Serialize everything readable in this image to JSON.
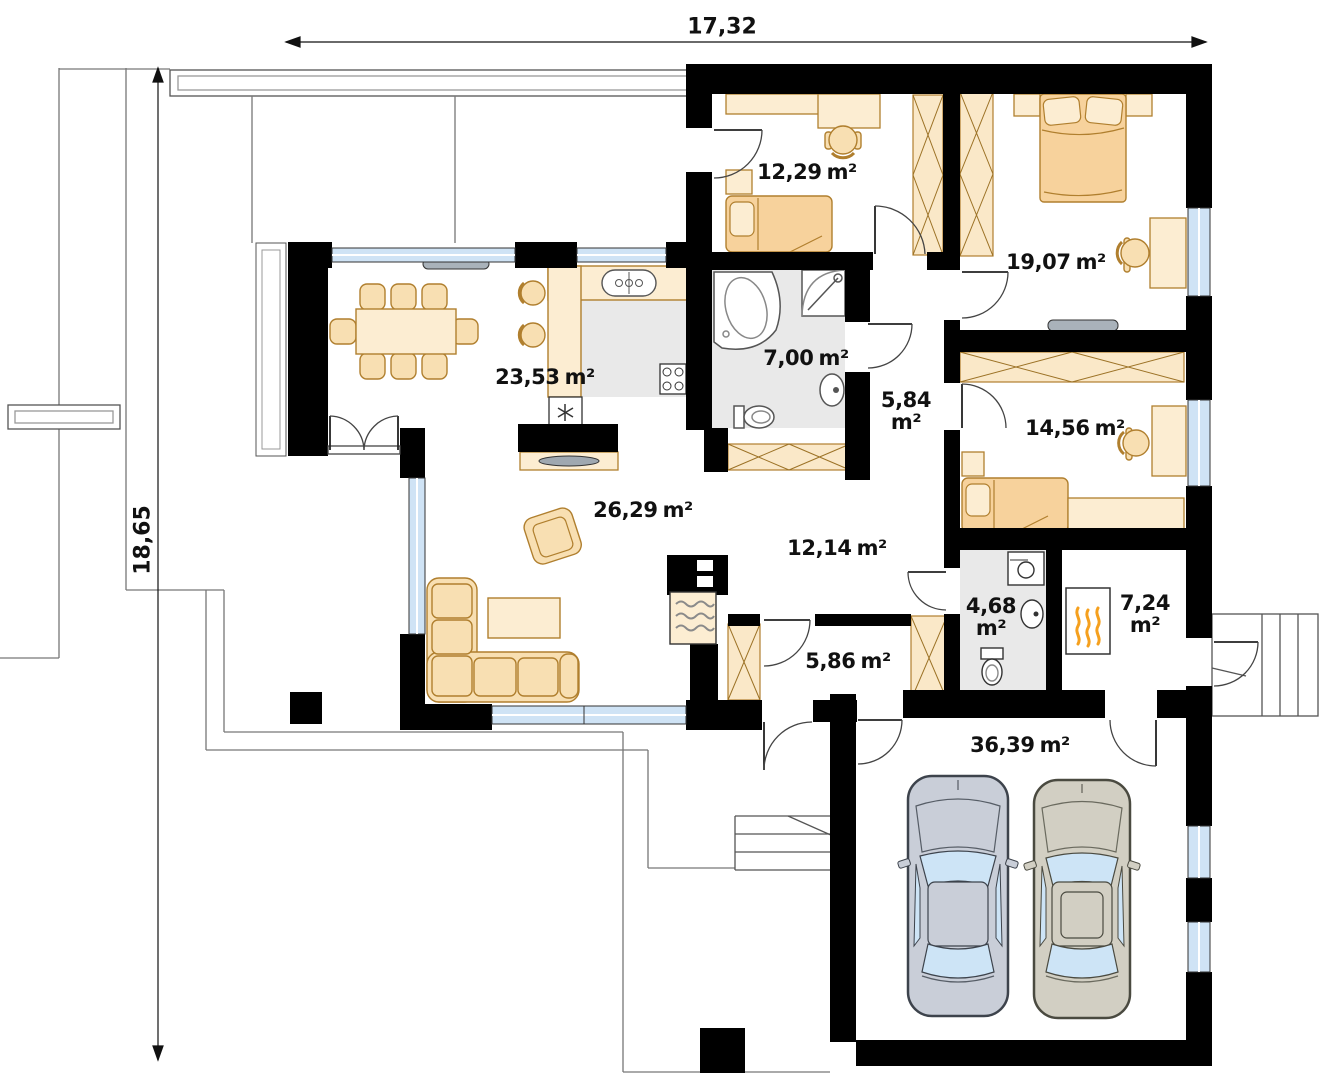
{
  "dimensions": {
    "top": "17,32",
    "left": "18,65"
  },
  "rooms": [
    {
      "value": "12,29",
      "unit": "m²"
    },
    {
      "value": "19,07",
      "unit": "m²"
    },
    {
      "value": "23,53",
      "unit": "m²"
    },
    {
      "value": "7,00",
      "unit": "m²"
    },
    {
      "value": "5,84",
      "unit": "m²"
    },
    {
      "value": "14,56",
      "unit": "m²"
    },
    {
      "value": "26,29",
      "unit": "m²"
    },
    {
      "value": "12,14",
      "unit": "m²"
    },
    {
      "value": "4,68",
      "unit": "m²"
    },
    {
      "value": "7,24",
      "unit": "m²"
    },
    {
      "value": "5,86",
      "unit": "m²"
    },
    {
      "value": "36,39",
      "unit": "m²"
    }
  ],
  "colors": {
    "wall": "#000000",
    "furniture": "#f8dfb2",
    "furniture_light": "#fcedd2",
    "bedding": "#f7d29c",
    "window_glass": "#cfe3f5",
    "floor_tile": "#e9e9e9",
    "radiator": "#a9b2ba",
    "car_left_body": "#c9ced8",
    "car_right_body": "#d2cfc3",
    "flame": "#f5a01e"
  }
}
